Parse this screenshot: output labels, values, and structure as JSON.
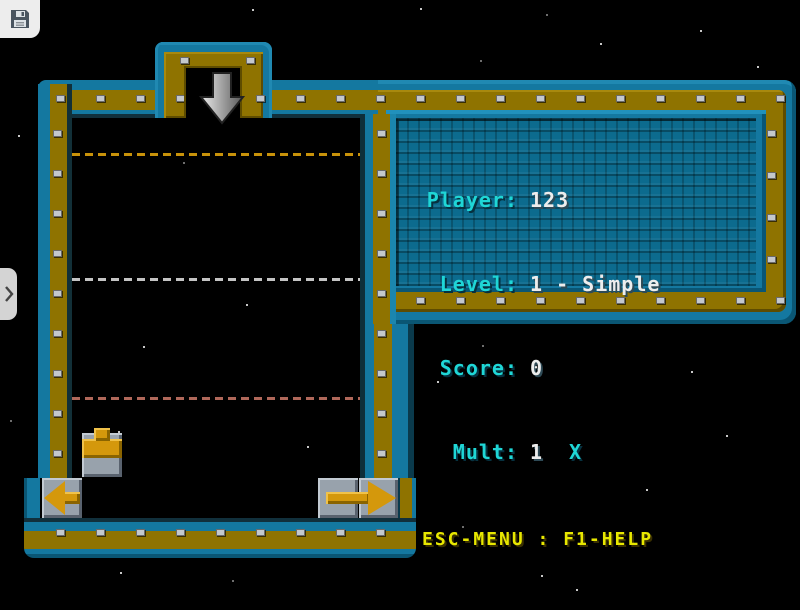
{
  "window": {
    "background": "#000000"
  },
  "toolbar": {
    "save_icon": "floppy-disk",
    "expand_icon": "chevron-right"
  },
  "hud": {
    "rows": [
      {
        "label": "Player:",
        "value": "123"
      },
      {
        "label": "Level:",
        "value": "1 - Simple"
      },
      {
        "label": "Score:",
        "value": "0"
      },
      {
        "label": "Mult:",
        "value": "1",
        "suffix": "X"
      }
    ],
    "footer": "ESC-MENU : F1-HELP",
    "colors": {
      "label": "#1FD6D6",
      "value": "#EDEDED",
      "footer": "#E8E800",
      "border_teal": "#1478A0",
      "border_gold": "#8F7300",
      "panel_interior": "#0C6B8E"
    }
  },
  "field": {
    "guide_lines": [
      {
        "y": 153,
        "color": "#C8920A"
      },
      {
        "y": 278,
        "color": "#C4C4C4"
      },
      {
        "y": 397,
        "color": "#B0685A"
      }
    ],
    "pieces": [
      {
        "name": "pipe-tee-up",
        "x": 82,
        "y": 433,
        "w": 40,
        "h": 44
      },
      {
        "name": "arrow-left",
        "x": 42,
        "y": 478,
        "w": 40,
        "h": 40
      },
      {
        "name": "arrow-right",
        "x": 318,
        "y": 478,
        "w": 80,
        "h": 40
      }
    ],
    "drop_arrow": {
      "x": 199,
      "y": 70
    }
  },
  "background": {
    "stars": [
      [
        252,
        9
      ],
      [
        420,
        8
      ],
      [
        546,
        14
      ],
      [
        700,
        30
      ],
      [
        600,
        43
      ],
      [
        480,
        60
      ],
      [
        757,
        66
      ],
      [
        18,
        135
      ],
      [
        183,
        162
      ],
      [
        246,
        304
      ],
      [
        143,
        346
      ],
      [
        10,
        420
      ],
      [
        118,
        431
      ],
      [
        307,
        446
      ],
      [
        482,
        345
      ],
      [
        437,
        381
      ],
      [
        691,
        371
      ],
      [
        762,
        300
      ],
      [
        646,
        489
      ],
      [
        726,
        435
      ],
      [
        462,
        526
      ],
      [
        541,
        575
      ],
      [
        576,
        589
      ],
      [
        232,
        580
      ],
      [
        120,
        572
      ]
    ]
  }
}
